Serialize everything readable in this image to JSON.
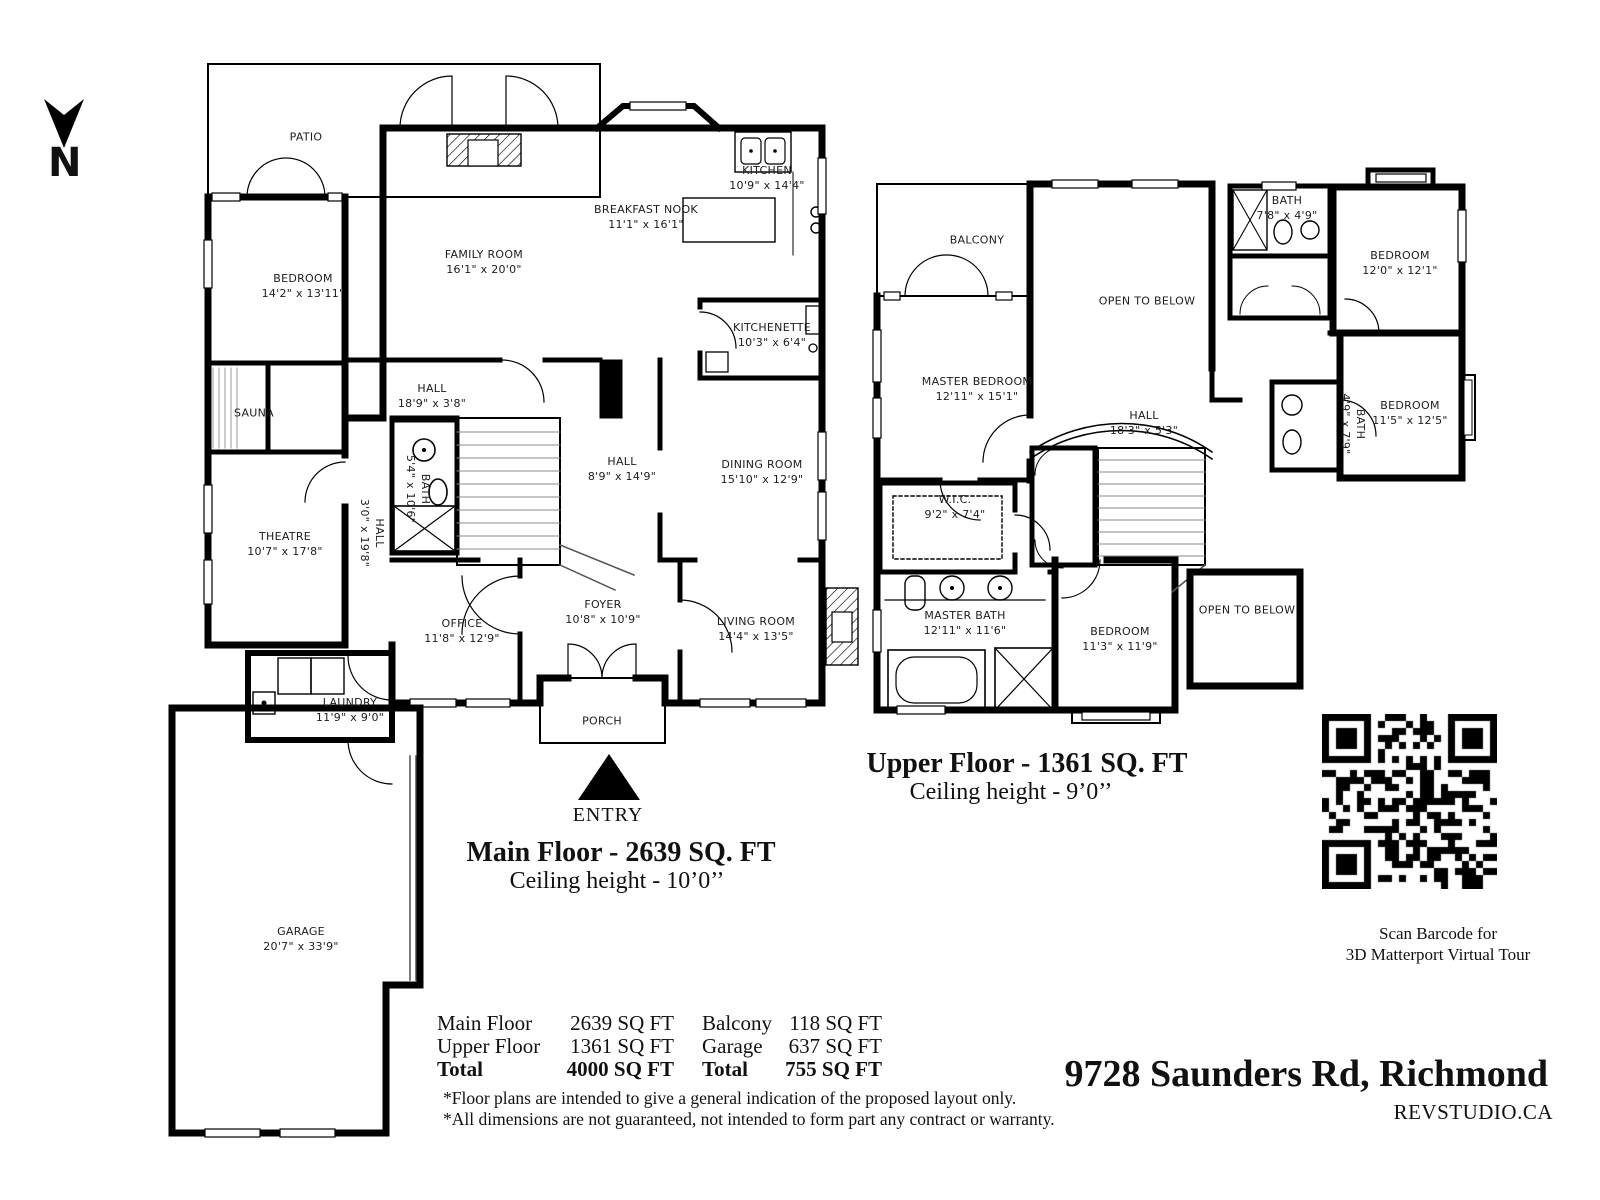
{
  "north": {
    "label": "N"
  },
  "main_floor": {
    "title": "Main Floor - 2639 SQ. FT",
    "ceiling": "Ceiling height - 10’0’’",
    "entry": "ENTRY",
    "rooms": {
      "patio": {
        "name": "PATIO",
        "dims": ""
      },
      "bedroom": {
        "name": "BEDROOM",
        "dims": "14'2\" x 13'11\""
      },
      "family_room": {
        "name": "FAMILY ROOM",
        "dims": "16'1\" x 20'0\""
      },
      "kitchen": {
        "name": "KITCHEN",
        "dims": "10'9\" x 14'4\""
      },
      "breakfast_nook": {
        "name": "BREAKFAST NOOK",
        "dims": "11'1\" x 16'1\""
      },
      "kitchenette": {
        "name": "KITCHENETTE",
        "dims": "10'3\" x 6'4\""
      },
      "hall_a": {
        "name": "HALL",
        "dims": "18'9\" x 3'8\""
      },
      "sauna": {
        "name": "SAUNA",
        "dims": ""
      },
      "bath": {
        "name": "BATH",
        "dims": "5'4\" x 10'6\""
      },
      "hall_b": {
        "name": "HALL",
        "dims": "8'9\" x 14'9\""
      },
      "hall_c": {
        "name": "HALL",
        "dims": "3'0\" x 19'8\""
      },
      "dining_room": {
        "name": "DINING ROOM",
        "dims": "15'10\" x 12'9\""
      },
      "theatre": {
        "name": "THEATRE",
        "dims": "10'7\" x 17'8\""
      },
      "office": {
        "name": "OFFICE",
        "dims": "11'8\" x 12'9\""
      },
      "foyer": {
        "name": "FOYER",
        "dims": "10'8\" x 10'9\""
      },
      "living_room": {
        "name": "LIVING ROOM",
        "dims": "14'4\" x 13'5\""
      },
      "laundry": {
        "name": "LAUNDRY",
        "dims": "11'9\" x 9'0\""
      },
      "porch": {
        "name": "PORCH",
        "dims": ""
      },
      "garage": {
        "name": "GARAGE",
        "dims": "20'7\" x 33'9\""
      }
    }
  },
  "upper_floor": {
    "title": "Upper Floor - 1361 SQ. FT",
    "ceiling": "Ceiling height - 9’0’’",
    "rooms": {
      "balcony": {
        "name": "BALCONY",
        "dims": ""
      },
      "open_below_a": {
        "name": "OPEN TO BELOW",
        "dims": ""
      },
      "master_bedroom": {
        "name": "MASTER BEDROOM",
        "dims": "12'11\" x 15'1\""
      },
      "bath_a": {
        "name": "BATH",
        "dims": "7'8\" x 4'9\""
      },
      "bedroom_a": {
        "name": "BEDROOM",
        "dims": "12'0\" x 12'1\""
      },
      "hall": {
        "name": "HALL",
        "dims": "18'3\" x 5'3\""
      },
      "bath_b": {
        "name": "BATH",
        "dims": "4'9\" x 7'9\""
      },
      "bedroom_b": {
        "name": "BEDROOM",
        "dims": "11'5\" x 12'5\""
      },
      "wic": {
        "name": "W.I.C.",
        "dims": "9'2\" x 7'4\""
      },
      "master_bath": {
        "name": "MASTER BATH",
        "dims": "12'11\" x 11'6\""
      },
      "bedroom_c": {
        "name": "BEDROOM",
        "dims": "11'3\" x 11'9\""
      },
      "open_below_b": {
        "name": "OPEN TO BELOW",
        "dims": ""
      }
    }
  },
  "summary": {
    "left": [
      {
        "label": "Main Floor",
        "value": "2639 SQ FT"
      },
      {
        "label": "Upper Floor",
        "value": "1361 SQ FT"
      },
      {
        "label": "Total",
        "value": "4000 SQ FT"
      }
    ],
    "right": [
      {
        "label": "Balcony",
        "value": "118 SQ FT"
      },
      {
        "label": "Garage",
        "value": "637 SQ FT"
      },
      {
        "label": "Total",
        "value": "755 SQ FT"
      }
    ]
  },
  "disclaimers": [
    "*Floor plans are intended to give a general indication of the proposed layout only.",
    "*All dimensions are not guaranteed, not intended to form part any contract or warranty."
  ],
  "qr": {
    "caption1": "Scan Barcode for",
    "caption2": "3D Matterport Virtual Tour"
  },
  "footer": {
    "address": "9728 Saunders Rd, Richmond",
    "brand": "REVSTUDIO.CA"
  }
}
